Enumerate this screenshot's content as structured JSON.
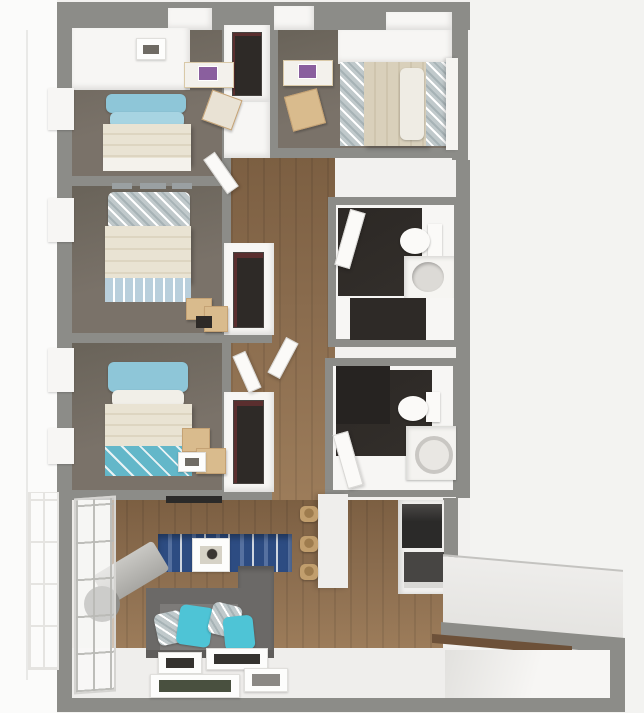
{
  "scene": {
    "type": "3d-floorplan-render",
    "view": "top-down dollhouse perspective",
    "rooms": [
      {
        "name": "bedroom-1",
        "position": "top-left",
        "furniture": [
          "bed-blue-pillows",
          "desk",
          "desk-chair",
          "wall-art",
          "window"
        ]
      },
      {
        "name": "bedroom-2",
        "position": "middle-left",
        "furniture": [
          "bed-patterned-pillows",
          "moving-boxes",
          "wall-decor",
          "window"
        ]
      },
      {
        "name": "bedroom-3",
        "position": "lower-left",
        "furniture": [
          "bed-blue-pillows",
          "moving-boxes",
          "closet",
          "window"
        ]
      },
      {
        "name": "bedroom-4",
        "position": "top-right",
        "furniture": [
          "bed-tan-comforter",
          "desk",
          "desk-chair"
        ]
      },
      {
        "name": "bathroom-1",
        "position": "right-middle",
        "furniture": [
          "toilet",
          "vanity-sink",
          "linen-closet",
          "door"
        ]
      },
      {
        "name": "bathroom-2",
        "position": "right-lower",
        "furniture": [
          "toilet",
          "washer",
          "dark-closet",
          "door"
        ]
      },
      {
        "name": "hallway",
        "position": "center",
        "furniture": [
          "closet-top",
          "closet-mid",
          "closet-low",
          "doors"
        ]
      },
      {
        "name": "kitchen",
        "position": "bottom-center",
        "furniture": [
          "refrigerator",
          "range",
          "counter",
          "island",
          "bar-stool",
          "bar-stool",
          "bar-stool"
        ]
      },
      {
        "name": "living-room",
        "position": "bottom-left",
        "furniture": [
          "sofa",
          "teal-throw-pillows",
          "patterned-throw-pillows",
          "blue-area-rug",
          "coffee-table-frame",
          "media-console",
          "rolled-rug",
          "floor-picture-frames",
          "floor-to-ceiling-windows"
        ]
      },
      {
        "name": "balcony",
        "position": "bottom-right",
        "furniture": []
      }
    ]
  },
  "colors": {
    "bg": "#f3f3f1",
    "bg-left": "#fbfbfa",
    "unit-white": "#f2f1ef",
    "wall": "#8c8c88",
    "white-top": "#f7f6f4",
    "bedroom-floor": "#7a7269",
    "bedroom-floor-dark": "#696359",
    "wood": "#8a6c4e",
    "wood-dark": "#7c5f42",
    "wood-light": "#9c7c5a",
    "bath-floor": "#332f2b",
    "closet-dark": "#2e2a27",
    "blanket": "#e9e3d3",
    "sheet": "#f4f2ec",
    "pillow-blue": "#8ec6d8",
    "teal": "#4ec4d6",
    "pattern": "#c0c9cb",
    "foot-blue": "#b9cfdc",
    "sofa": "#6b6967",
    "sofa-seat": "#7d7b79",
    "sofa-dark": "#5f5d5b",
    "rug-blue": "#2d4c82",
    "rug-blue-light": "#5671a0",
    "stool": "#c19e6d",
    "desk": "#d9bb8d",
    "appliance-dark": "#2b2a29",
    "appliance-gray": "#474543",
    "deck": "#eeedeb",
    "laptop-purple": "#8a5f9e"
  }
}
